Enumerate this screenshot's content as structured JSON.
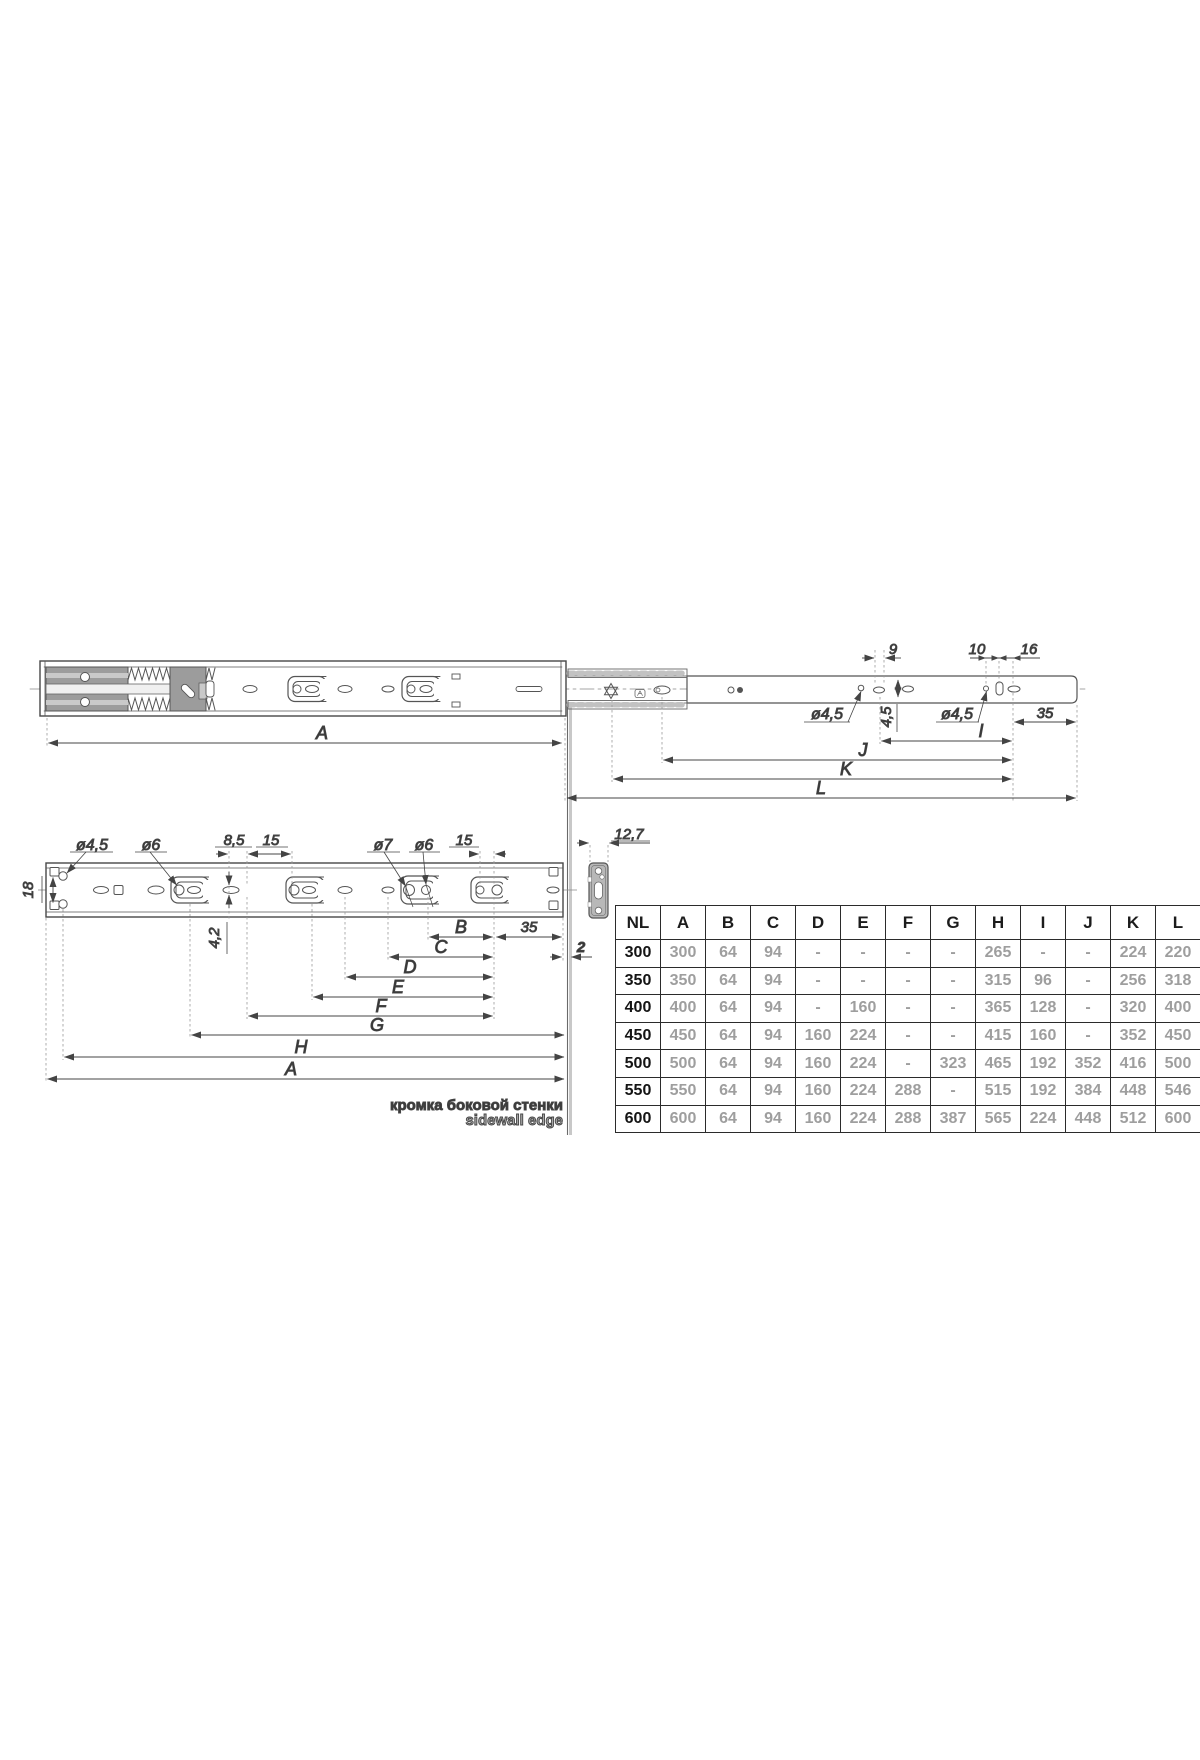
{
  "colors": {
    "line": "#474747",
    "gray_fill": "#9c9c9c",
    "light_fill": "#c9c9c9",
    "table_value_gray": "#9e9e9e",
    "table_text_black": "#1c1c1c"
  },
  "top_view": {
    "labels": {
      "d9": "9",
      "d10": "10",
      "d16": "16",
      "dia45_mid": "ø4,5",
      "d45_offset": "4,5",
      "dia45_right": "ø4,5",
      "d35": "35",
      "I": "I",
      "J": "J",
      "K": "K",
      "L": "L",
      "A": "A"
    }
  },
  "side_view": {
    "labels": {
      "dia45": "ø4,5",
      "dia6_left": "ø6",
      "d85": "8,5",
      "d15_left": "15",
      "dia7": "ø7",
      "dia6_right": "ø6",
      "d15_right": "15",
      "d18": "18",
      "d42": "4,2",
      "d127": "12,7",
      "d2": "2",
      "B": "B",
      "d35": "35",
      "C": "C",
      "D": "D",
      "E": "E",
      "F": "F",
      "G": "G",
      "H": "H",
      "A": "A"
    },
    "note_ru": "кромка боковой стенки",
    "note_en": "sidewall edge"
  },
  "table": {
    "headers": [
      "NL",
      "A",
      "B",
      "C",
      "D",
      "E",
      "F",
      "G",
      "H",
      "I",
      "J",
      "K",
      "L"
    ],
    "rows": [
      [
        "300",
        "300",
        "64",
        "94",
        "-",
        "-",
        "-",
        "-",
        "265",
        "-",
        "-",
        "224",
        "220"
      ],
      [
        "350",
        "350",
        "64",
        "94",
        "-",
        "-",
        "-",
        "-",
        "315",
        "96",
        "-",
        "256",
        "318"
      ],
      [
        "400",
        "400",
        "64",
        "94",
        "-",
        "160",
        "-",
        "-",
        "365",
        "128",
        "-",
        "320",
        "400"
      ],
      [
        "450",
        "450",
        "64",
        "94",
        "160",
        "224",
        "-",
        "-",
        "415",
        "160",
        "-",
        "352",
        "450"
      ],
      [
        "500",
        "500",
        "64",
        "94",
        "160",
        "224",
        "-",
        "323",
        "465",
        "192",
        "352",
        "416",
        "500"
      ],
      [
        "550",
        "550",
        "64",
        "94",
        "160",
        "224",
        "288",
        "-",
        "515",
        "192",
        "384",
        "448",
        "546"
      ],
      [
        "600",
        "600",
        "64",
        "94",
        "160",
        "224",
        "288",
        "387",
        "565",
        "224",
        "448",
        "512",
        "600"
      ]
    ]
  }
}
